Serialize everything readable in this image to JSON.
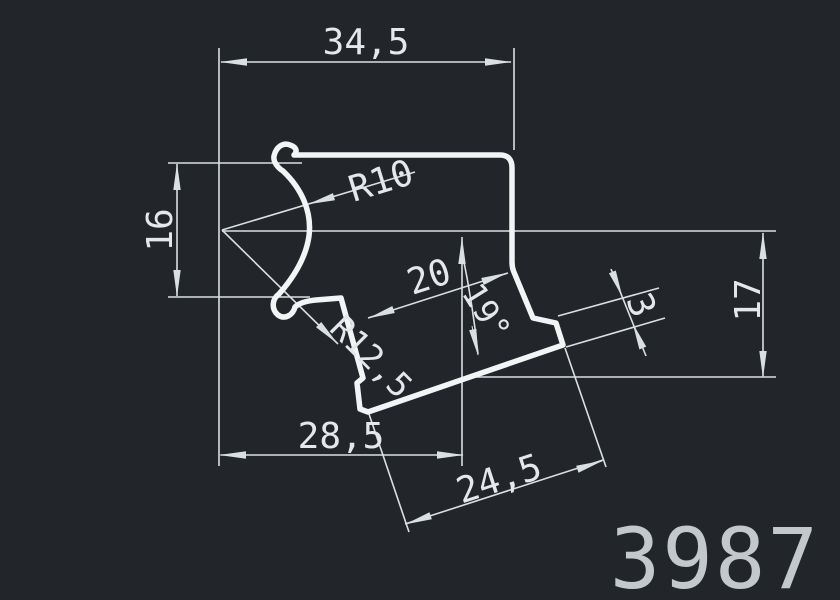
{
  "colors": {
    "background": "#22262b",
    "line_profile": "#f2f4f6",
    "line_thin": "#dadfe2",
    "text": "#e4e8ea",
    "part_number_color": "#c3c8cc"
  },
  "drawing": {
    "type": "cad-profile-cross-section",
    "part_number": "3987",
    "dimensions": {
      "top_width": "34,5",
      "left_height": "16",
      "channel_inner_radius": "R10",
      "channel_outer_radius": "R12,5",
      "flange_top_length": "20",
      "flange_angle": "19°",
      "lip_thickness": "3",
      "right_height": "17",
      "bottom_width": "28,5",
      "flange_bottom_length": "24,5"
    }
  }
}
